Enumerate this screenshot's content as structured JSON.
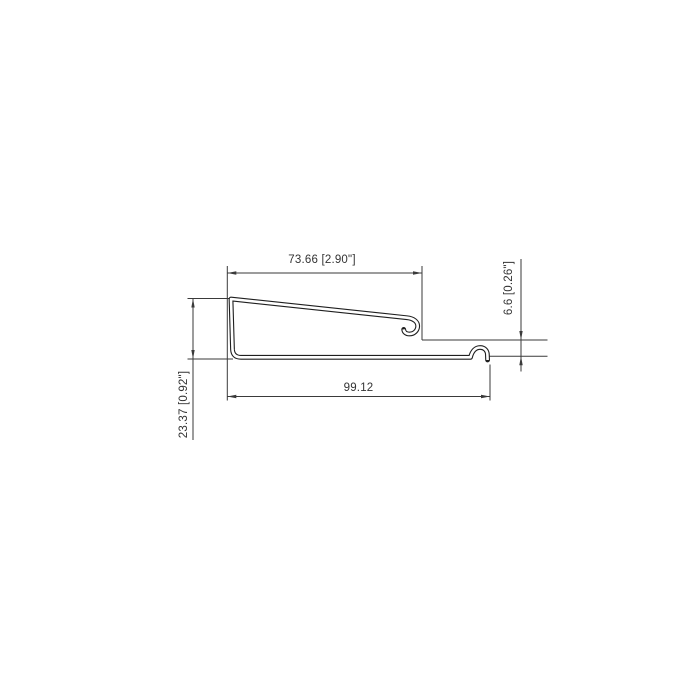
{
  "drawing": {
    "description": "sheet-metal profile cross-section, dimensioned",
    "dimensions": {
      "top_width": "73.66 [2.90\"]",
      "right_height": "6.6 [0.26\"]",
      "left_height": "23.37 [0.92\"]",
      "bottom_width": "99.12"
    },
    "colors": {
      "background": "#ffffff",
      "dimension_lines": "#3a3a3a",
      "profile_outline": "#1f1f1f",
      "text": "#333333"
    }
  }
}
